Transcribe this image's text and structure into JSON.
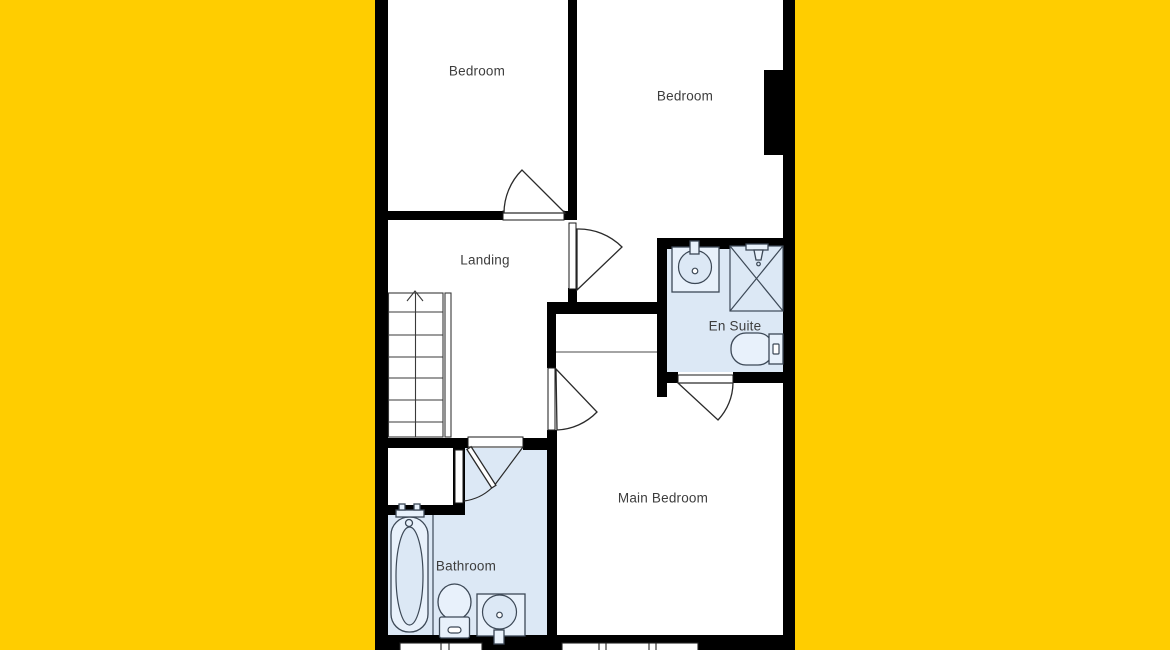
{
  "floorplan": {
    "colors": {
      "background": "#FFCD00",
      "walls": "#000000",
      "wet_room_fill": "#DCE8F5",
      "fixture_line": "#3C4856",
      "label_text": "#3D3D3D"
    },
    "rooms": {
      "bedroom_left": {
        "label": "Bedroom"
      },
      "bedroom_right": {
        "label": "Bedroom"
      },
      "landing": {
        "label": "Landing"
      },
      "en_suite": {
        "label": "En Suite"
      },
      "main_bedroom": {
        "label": "Main Bedroom"
      },
      "bathroom": {
        "label": "Bathroom"
      }
    },
    "fixtures": {
      "bathroom": [
        "bathtub",
        "toilet",
        "washbasin"
      ],
      "en_suite": [
        "washbasin",
        "shower",
        "toilet"
      ]
    },
    "features": [
      "staircase-up",
      "built-in-cupboard",
      "chimney-breast",
      "windows",
      "door-swings"
    ]
  }
}
